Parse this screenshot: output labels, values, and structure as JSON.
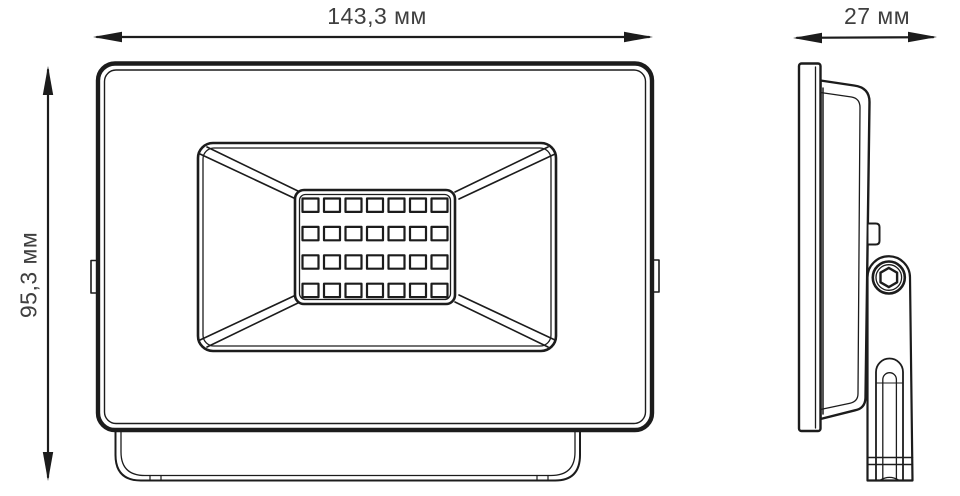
{
  "diagram": {
    "type": "technical-dimension-drawing",
    "views": {
      "front": "front-view",
      "side": "side-view"
    },
    "dimensions": {
      "width": {
        "label": "143,3 мм",
        "value": "143,3",
        "unit": "мм"
      },
      "height": {
        "label": "95,3 мм",
        "value": "95,3",
        "unit": "мм"
      },
      "depth": {
        "label": "27 мм",
        "value": "27",
        "unit": "мм"
      }
    },
    "led_grid": {
      "columns": 7,
      "rows": 4
    },
    "colors": {
      "line": "#1c1c1c",
      "text": "#3f3f3f",
      "background": "#ffffff"
    }
  }
}
